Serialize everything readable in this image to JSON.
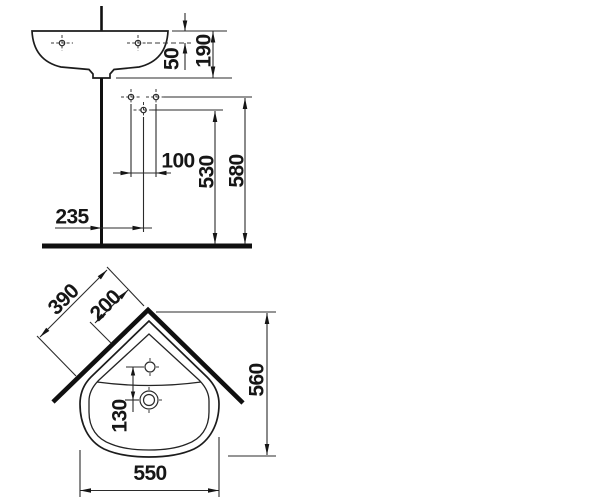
{
  "drawing": {
    "type": "corner-washbasin-installation-dimensions",
    "colors": {
      "line": "#1c1c1c",
      "heavy_line": "#101010",
      "background": "#ffffff"
    },
    "side_view": {
      "dim_rim_to_tap_holes": "50",
      "dim_basin_height": "190",
      "dim_connection_spacing": "100",
      "dim_waste_height": "530",
      "dim_inlet_height": "580",
      "dim_waste_offset": "235"
    },
    "plan_view": {
      "dim_wall_edge": "390",
      "dim_corner_offset": "200",
      "dim_depth": "560",
      "dim_tap_to_waste": "130",
      "dim_width": "550"
    }
  }
}
